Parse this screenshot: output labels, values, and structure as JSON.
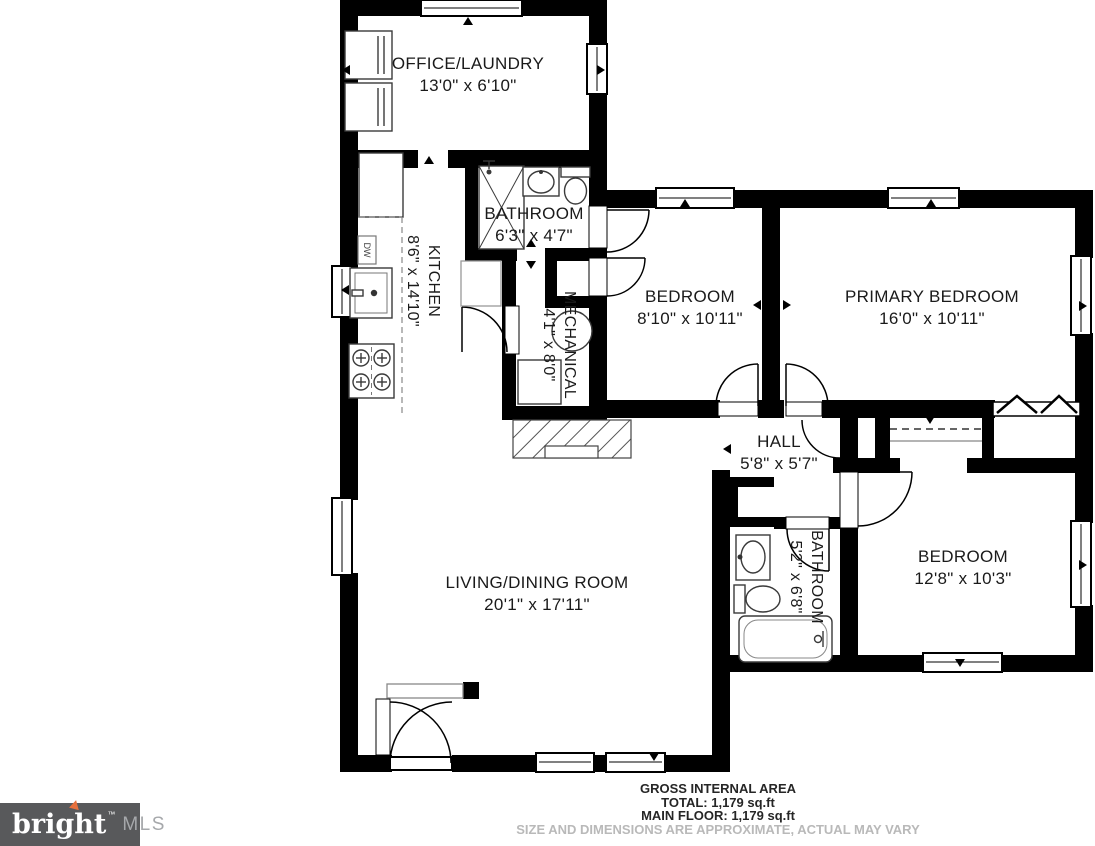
{
  "plan": {
    "rooms": [
      {
        "id": "office-laundry",
        "name": "OFFICE/LAUNDRY",
        "dims": "13'0\" x 6'10\""
      },
      {
        "id": "bathroom-upper",
        "name": "BATHROOM",
        "dims": "6'3\" x 4'7\""
      },
      {
        "id": "kitchen",
        "name": "KITCHEN",
        "dims": "8'6\" x 14'10\""
      },
      {
        "id": "bedroom-middle",
        "name": "BEDROOM",
        "dims": "8'10\" x 10'11\""
      },
      {
        "id": "primary-bedroom",
        "name": "PRIMARY BEDROOM",
        "dims": "16'0\" x 10'11\""
      },
      {
        "id": "mechanical",
        "name": "MECHANICAL",
        "dims": "4'1\" x 8'0\""
      },
      {
        "id": "hall",
        "name": "HALL",
        "dims": "5'8\" x 5'7\""
      },
      {
        "id": "bathroom-lower",
        "name": "BATHROOM",
        "dims": "5'2\" x 6'8\""
      },
      {
        "id": "bedroom-right",
        "name": "BEDROOM",
        "dims": "12'8\" x 10'3\""
      },
      {
        "id": "living-dining",
        "name": "LIVING/DINING ROOM",
        "dims": "20'1\" x 17'11\""
      }
    ],
    "kitchen": {
      "dw_label": "DW"
    },
    "footer": {
      "area_title": "GROSS INTERNAL AREA",
      "total": "TOTAL: 1,179 sq.ft",
      "main_floor": "MAIN FLOOR: 1,179 sq.ft",
      "disclaimer": "SIZE AND DIMENSIONS ARE APPROXIMATE, ACTUAL MAY VARY"
    },
    "logo": {
      "brand": "bright",
      "tm": "™",
      "suffix": "MLS"
    },
    "colors": {
      "wall": "#000000",
      "label_text": "#1a1a1a",
      "footer_text": "#262626",
      "disclaimer_text": "#b9b9b9",
      "logo_bg": "#58595b",
      "logo_brand": "#ffffff",
      "logo_suffix": "#a6a8ab",
      "logo_accent": "#e8703c"
    }
  }
}
